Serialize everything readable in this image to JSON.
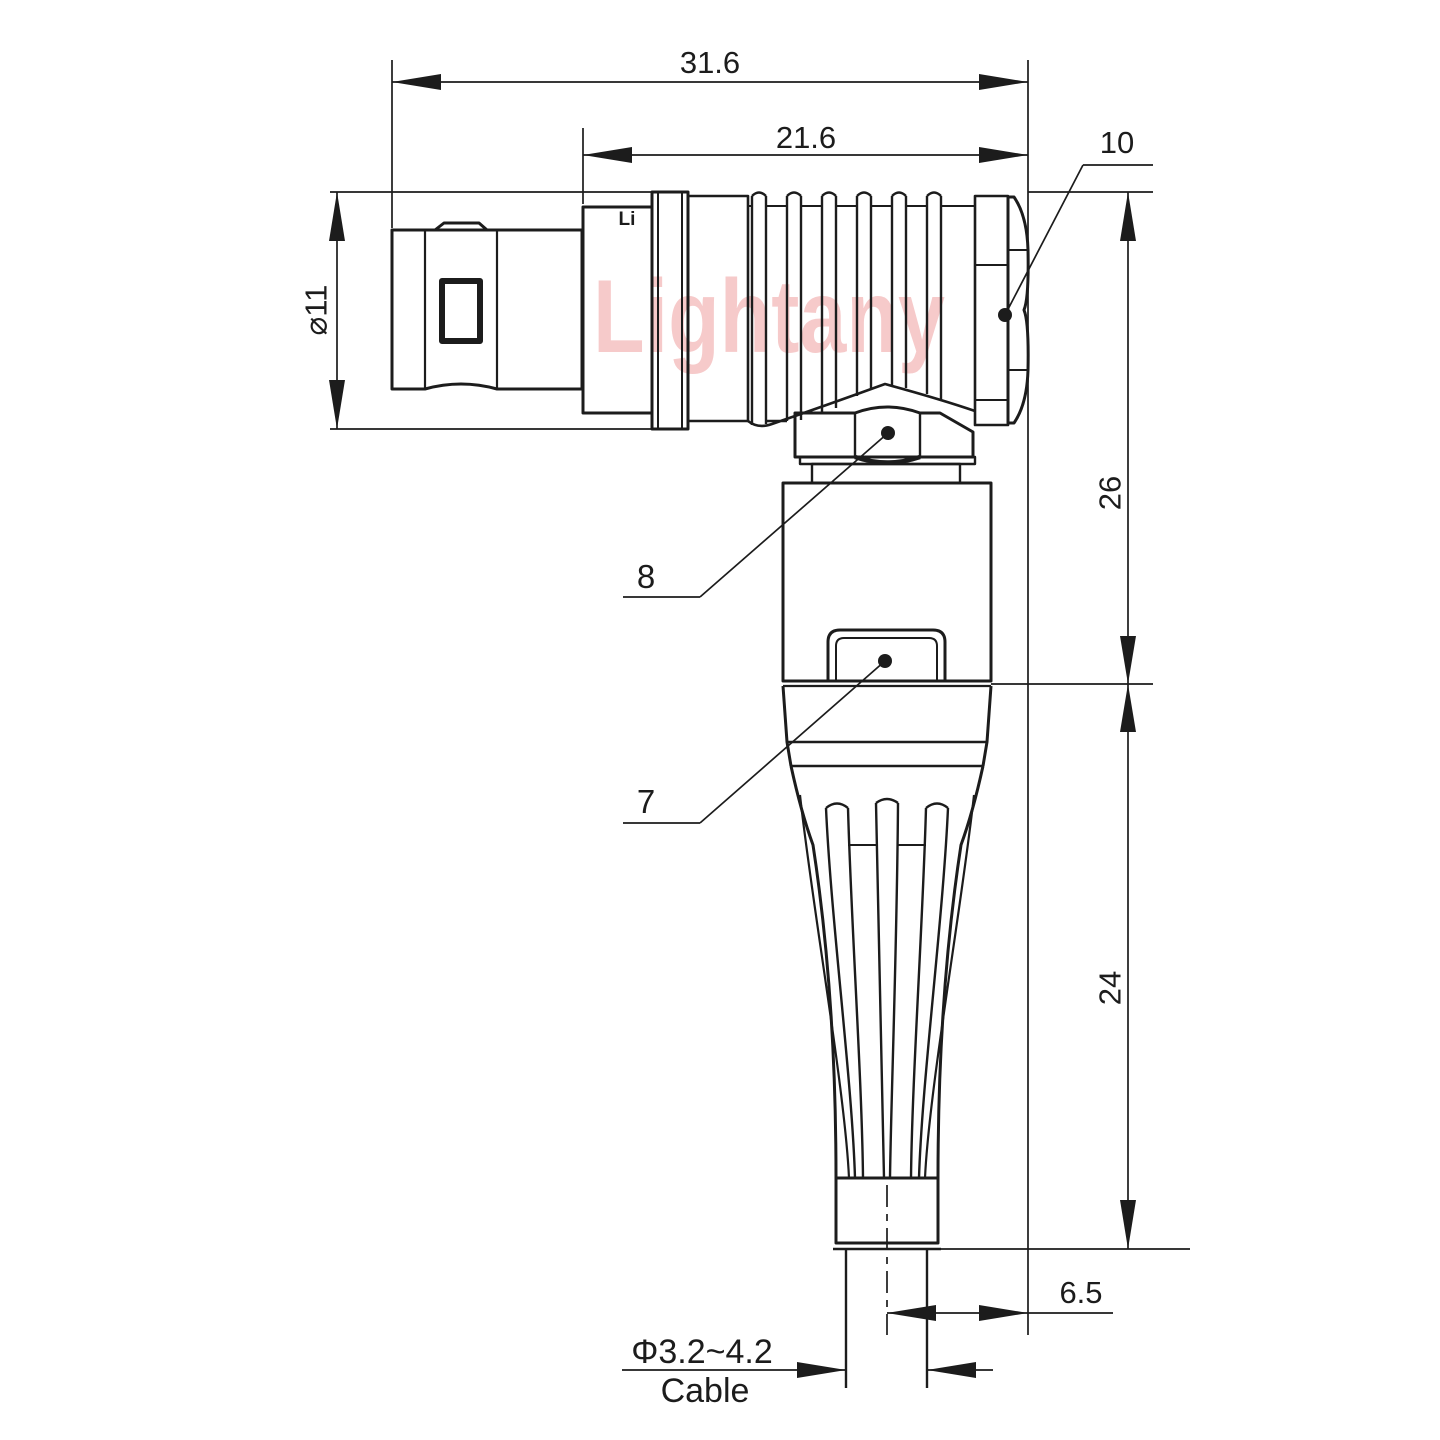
{
  "drawing": {
    "watermark": "Lightany",
    "sleeve_logo": "Li",
    "dimensions": {
      "overall_length": "31.6",
      "body_length": "21.6",
      "shell_diameter": "⌀11",
      "height_upper": "26",
      "height_lower": "24",
      "cable_offset": "6.5",
      "cable_diameter": "Φ3.2~4.2",
      "cable_label": "Cable"
    },
    "part_labels": {
      "hex_cap": "10",
      "elbow_nut": "8",
      "release_latch": "7"
    },
    "colors": {
      "line": "#1c1c1c",
      "watermark": "#f6caca",
      "background": "#ffffff"
    }
  }
}
